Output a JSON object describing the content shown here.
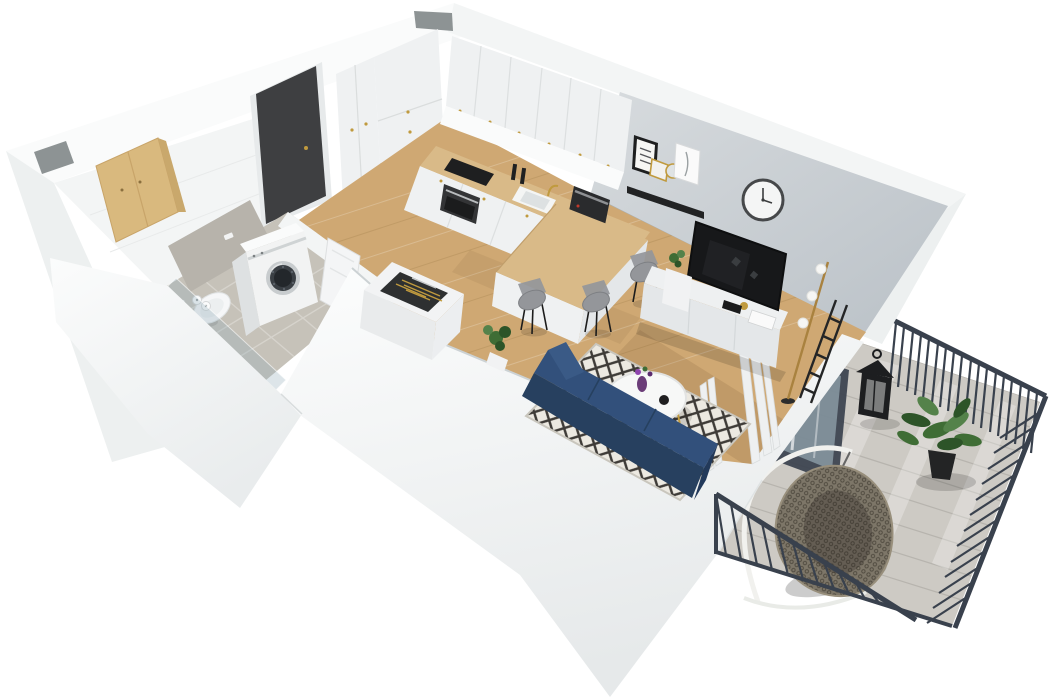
{
  "scene": {
    "title": "3D isometric floor plan render of a studio apartment with balcony",
    "type": "architectural-3d-floorplan",
    "background": "#ffffff",
    "rooms": [
      {
        "name": "hallway",
        "floor": "wood",
        "items": [
          "entrance-door",
          "tall-wardrobe",
          "tall-fridge-cabinet"
        ]
      },
      {
        "name": "bathroom",
        "floor": "gray-tile",
        "items": [
          "wood-wall-cabinet",
          "tiled-flush-panel",
          "wall-hung-toilet",
          "toilet-paper-rolls",
          "washing-machine",
          "washbasin-vanity",
          "navy-towel",
          "glass-shower-panel",
          "open-white-door"
        ]
      },
      {
        "name": "kitchen",
        "floor": "wood",
        "items": [
          "upper-cabinets",
          "base-cabinets",
          "wood-countertop",
          "induction-cooktop",
          "built-in-oven",
          "sink",
          "gold-faucet",
          "pepper-grinders",
          "coffee-machine",
          "peninsula-counter",
          "cutlery-drawer-cabinet"
        ]
      },
      {
        "name": "living-room",
        "floor": "wood",
        "items": [
          "gray-accent-wall",
          "wall-clock",
          "picture-ledge",
          "poster-frame",
          "gold-frame",
          "round-mirror",
          "feather-frame",
          "tv",
          "tv-sideboard",
          "floor-lamp",
          "decor-ladder",
          "side-pedestal",
          "pedestal-plant",
          "curtains",
          "balcony-glass-door",
          "diamond-rug",
          "round-coffee-table",
          "purple-vase",
          "book",
          "black-bowl",
          "navy-sofa",
          "corner-plant",
          "bar-stool",
          "bar-stool",
          "bar-stool"
        ]
      },
      {
        "name": "balcony",
        "floor": "gray-decking",
        "items": [
          "metal-railing-back",
          "metal-railing-right",
          "metal-railing-front",
          "hanging-egg-chair",
          "chair-stand",
          "candle-lantern",
          "potted-plant"
        ]
      }
    ],
    "palette": {
      "wall-bright": "#fafbfb",
      "wall-light": "#f3f5f5",
      "wall-mid": "#edf0f0",
      "wall-shade": "#e7eaeb",
      "wall-deep": "#dde1e2",
      "accent-wall-a": "#d7dbde",
      "accent-wall-b": "#bac1c7",
      "wood-floor": "#cfa873",
      "counter-wood": "#d9ba88",
      "bath-cabinet-wood": "#d9b97e",
      "cabinet": "#eff1f2",
      "cabinet-shade": "#e4e7e9",
      "tile-floor": "#c6c2b9",
      "tile-backer": "#b7b3ab",
      "deck": "#cdcac4",
      "deck-line": "#b7b4ae",
      "railing": "#39414d",
      "sofa-seat": "#32507b",
      "sofa-back": "#27405f",
      "towel-navy": "#2e4a70",
      "rug-base": "#ece9e1",
      "rug-pattern": "#3e3b37",
      "tv-screen": "#17181a",
      "appliance": "#2a2b2d",
      "entry-door": "#3e3f41",
      "gold": "#c09a3e",
      "curtain": "#eef0f1",
      "green-dark": "#2d5428",
      "green-mid": "#3f6d35",
      "green-light": "#54824a",
      "lantern": "#1d1e20",
      "rattan": "#7d7668",
      "rattan-dark": "#5f5950",
      "stool": "#94969a"
    }
  }
}
